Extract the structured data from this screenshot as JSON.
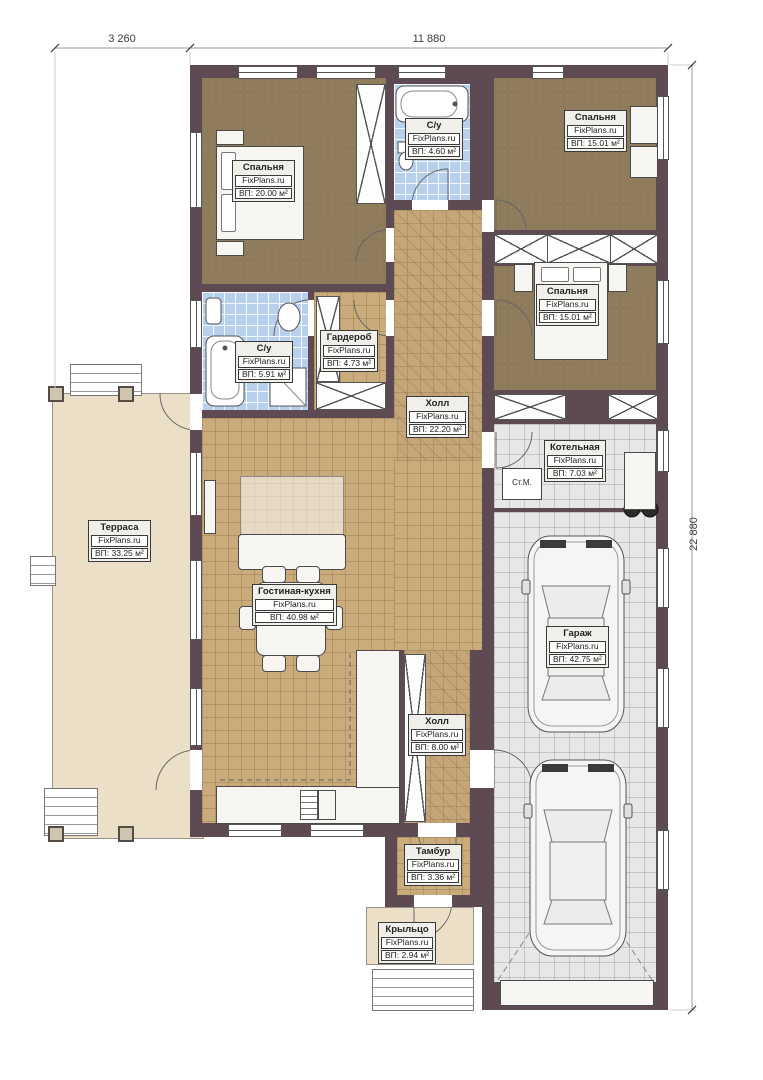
{
  "plan": {
    "dimensions": {
      "width_left": "3 260",
      "width_main": "11 880",
      "height_right": "22 880"
    },
    "brand": "FixPlans.ru",
    "rooms": {
      "bedroom1": {
        "name": "Спальня",
        "brand": "FixPlans.ru",
        "area": "ВП: 20.00 м²"
      },
      "bath1": {
        "name": "С/у",
        "brand": "FixPlans.ru",
        "area": "ВП: 4.60 м²"
      },
      "bedroom2": {
        "name": "Спальня",
        "brand": "FixPlans.ru",
        "area": "ВП: 15.01 м²"
      },
      "bedroom3": {
        "name": "Спальня",
        "brand": "FixPlans.ru",
        "area": "ВП: 15.01 м²"
      },
      "bath2": {
        "name": "С/у",
        "brand": "FixPlans.ru",
        "area": "ВП: 5.91 м²"
      },
      "wardrobe": {
        "name": "Гардероб",
        "brand": "FixPlans.ru",
        "area": "ВП: 4.73 м²"
      },
      "hall1": {
        "name": "Холл",
        "brand": "FixPlans.ru",
        "area": "ВП: 22.20 м²"
      },
      "boiler": {
        "name": "Котельная",
        "brand": "FixPlans.ru",
        "area": "ВП: 7.03 м²"
      },
      "terrace": {
        "name": "Терраса",
        "brand": "FixPlans.ru",
        "area": "ВП: 33.25 м²"
      },
      "living": {
        "name": "Гостиная-кухня",
        "brand": "FixPlans.ru",
        "area": "ВП: 40.98 м²"
      },
      "garage": {
        "name": "Гараж",
        "brand": "FixPlans.ru",
        "area": "ВП: 42.75 м²"
      },
      "hall2": {
        "name": "Холл",
        "brand": "FixPlans.ru",
        "area": "ВП: 8.00 м²"
      },
      "tambour": {
        "name": "Тамбур",
        "brand": "FixPlans.ru",
        "area": "ВП: 3.36 м²"
      },
      "porch": {
        "name": "Крыльцо",
        "brand": "FixPlans.ru",
        "area": "ВП: 2.94 м²"
      }
    },
    "annotations": {
      "washing_machine": "Ст.М."
    },
    "colors": {
      "wall": "#5e4a52",
      "tile_floor": "#c9ab7c",
      "bedroom_floor": "#8d7b5c",
      "bath_floor": "#b7d0ec",
      "garage_floor": "#e7e7e7",
      "terrace_floor": "#ecdfc8"
    }
  }
}
